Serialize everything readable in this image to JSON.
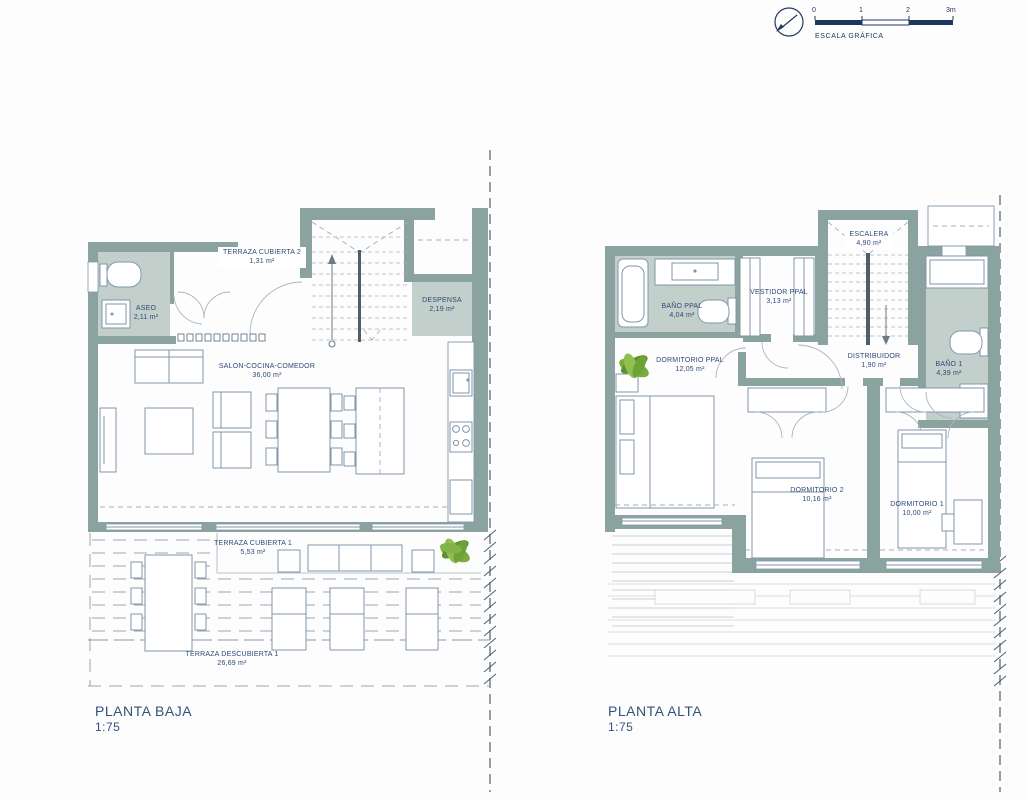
{
  "scale_graphic": {
    "ticks": [
      "0",
      "1",
      "2",
      "3m"
    ],
    "caption": "ESCALA GRÁFICA"
  },
  "plans": [
    {
      "title": "PLANTA BAJA",
      "scale": "1:75",
      "rooms": [
        {
          "name": "TERRAZA CUBIERTA 2",
          "area": "1,31 m²"
        },
        {
          "name": "ASEO",
          "area": "2,11 m²"
        },
        {
          "name": "DESPENSA",
          "area": "2,19 m²"
        },
        {
          "name": "SALON-COCINA-COMEDOR",
          "area": "36,00 m²"
        },
        {
          "name": "TERRAZA CUBIERTA 1",
          "area": "5,53 m²"
        },
        {
          "name": "TERRAZA DESCUBIERTA 1",
          "area": "26,69 m²"
        }
      ]
    },
    {
      "title": "PLANTA ALTA",
      "scale": "1:75",
      "rooms": [
        {
          "name": "ESCALERA",
          "area": "4,90 m²"
        },
        {
          "name": "BAÑO PPAL",
          "area": "4,04 m²"
        },
        {
          "name": "VESTIDOR PPAL",
          "area": "3,13 m²"
        },
        {
          "name": "BAÑO 1",
          "area": "4,39 m²"
        },
        {
          "name": "DORMITORIO PPAL",
          "area": "12,05 m²"
        },
        {
          "name": "DISTRIBUIDOR",
          "area": "1,90 m²"
        },
        {
          "name": "DORMITORIO 2",
          "area": "10,16 m²"
        },
        {
          "name": "DORMITORIO 1",
          "area": "10,00 m²"
        }
      ]
    }
  ],
  "colors": {
    "wall": "#8ba39e",
    "room_fill": "#c2cfca",
    "furniture_line": "#8296ab",
    "label_text": "#2e4a78",
    "scale_bar": "#21375f",
    "plant_green": "#79ab3d"
  }
}
